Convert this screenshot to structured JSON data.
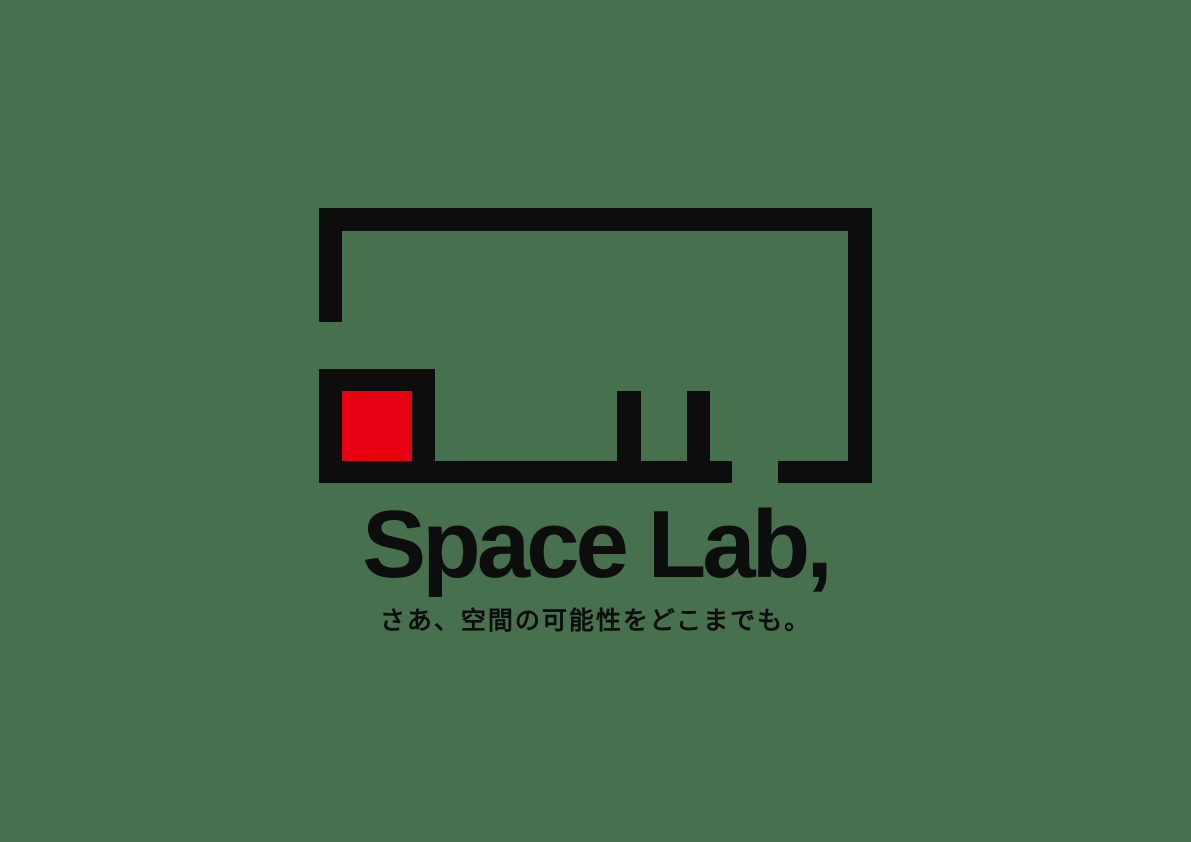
{
  "colors": {
    "background": "#47714e",
    "mark-black": "#0d0d0d",
    "accent-red": "#e60012"
  },
  "logo": {
    "wordmark": "Space Lab,",
    "tagline": "さあ、空間の可能性をどこまでも。"
  }
}
